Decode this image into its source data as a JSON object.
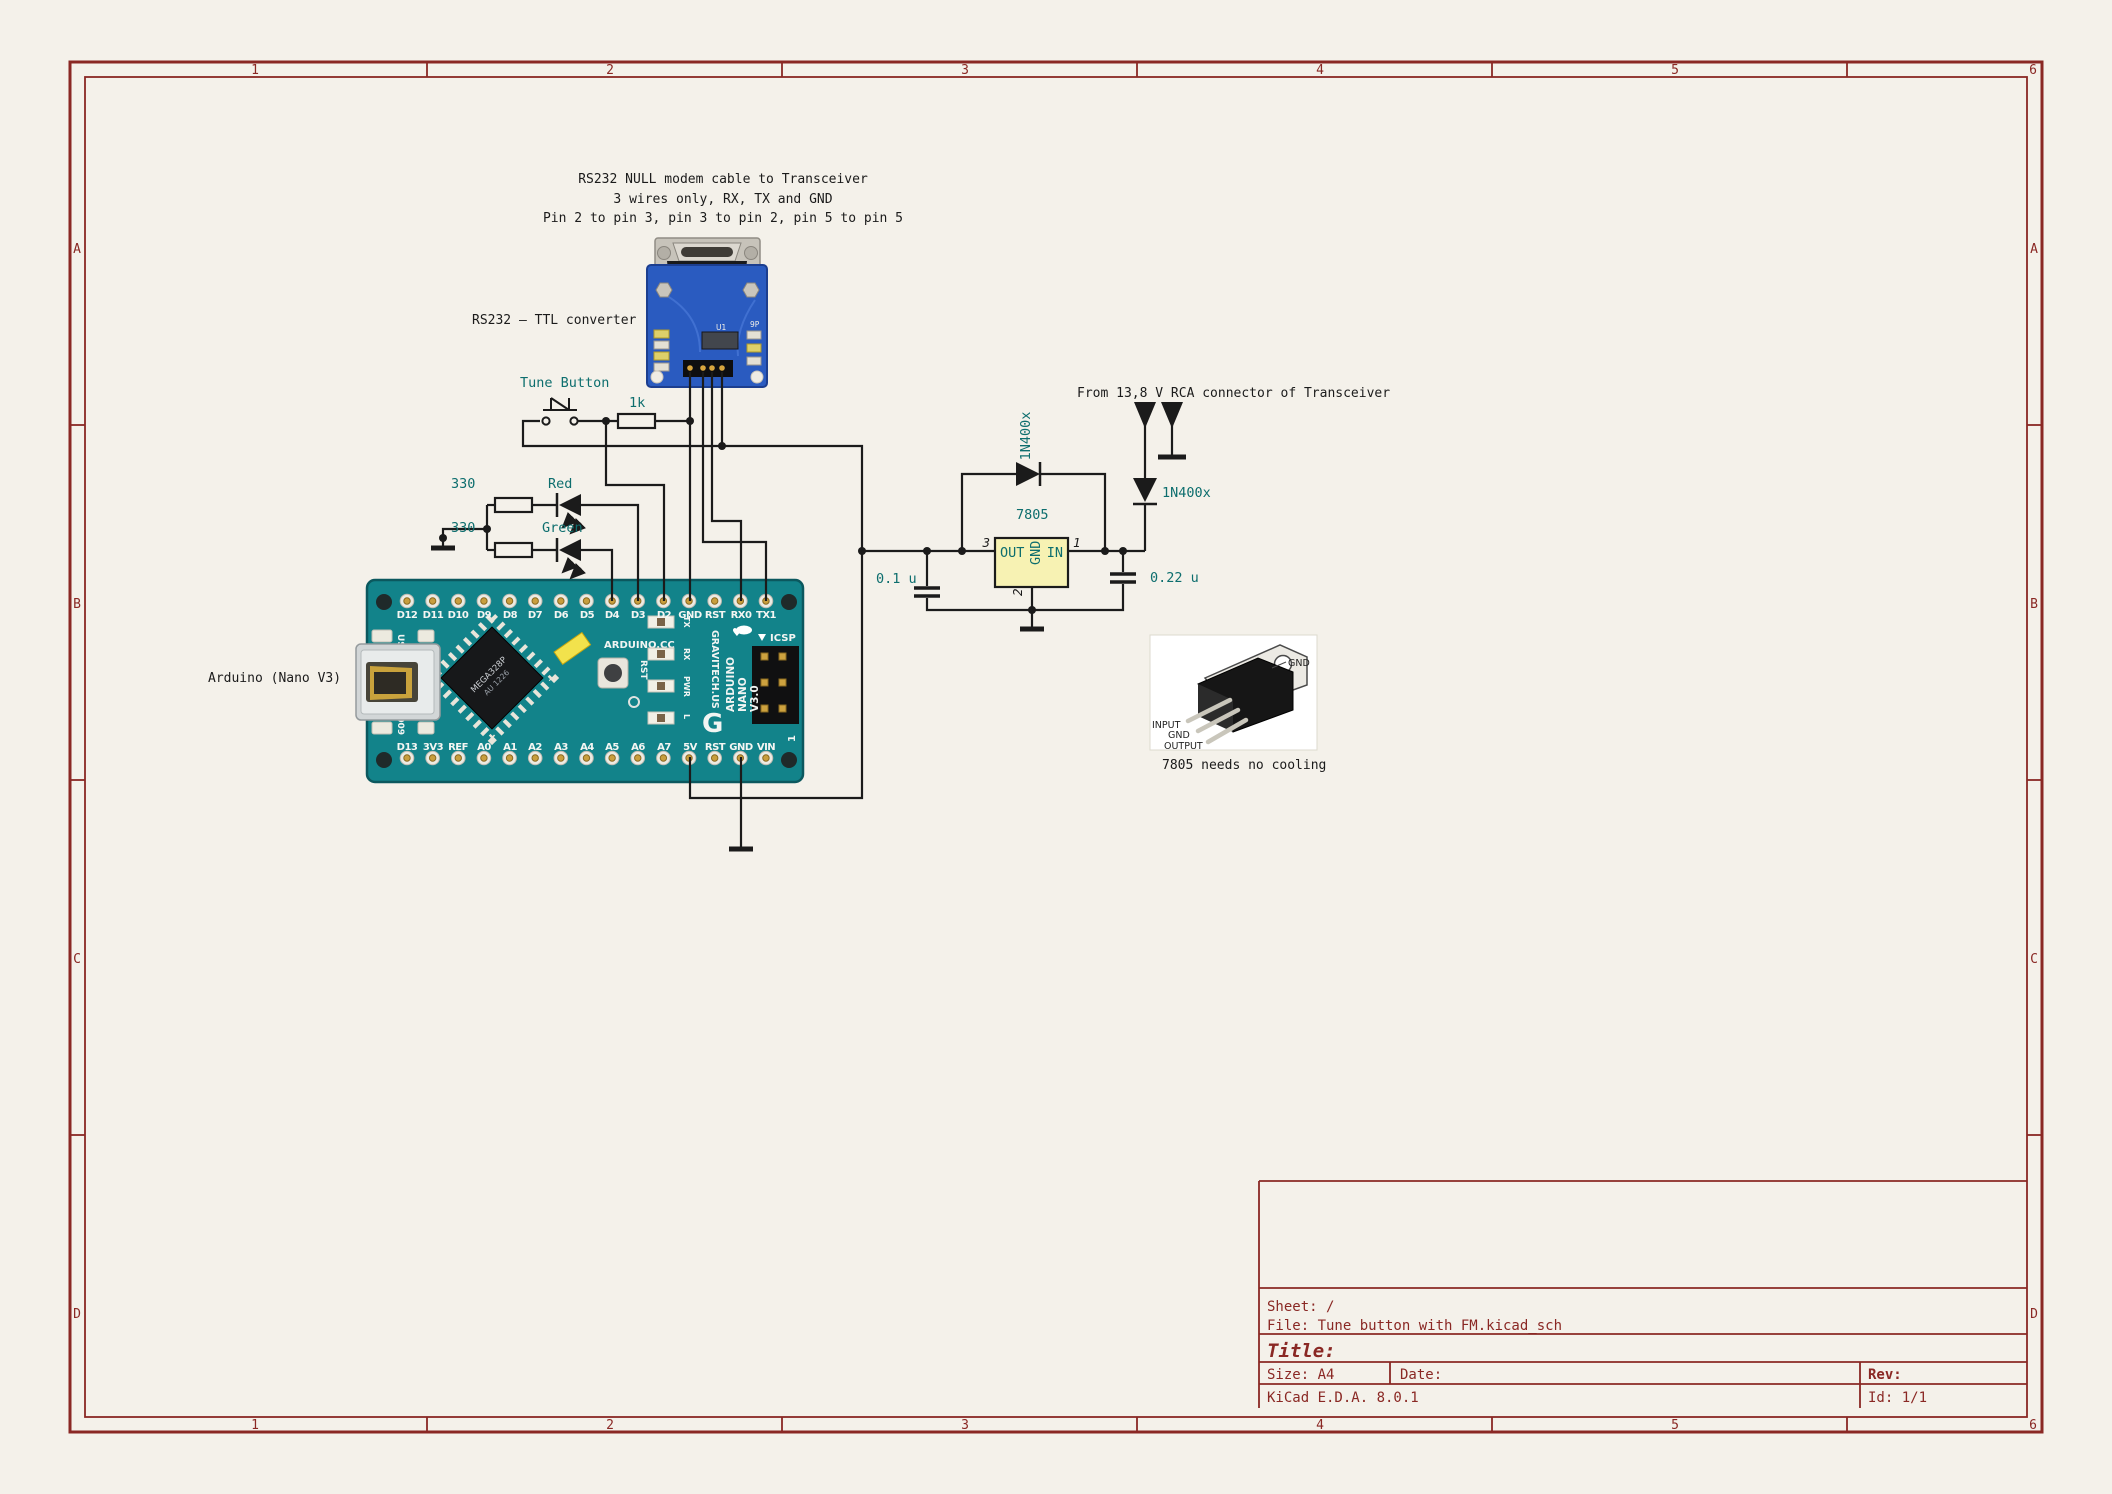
{
  "colors": {
    "paper": "#f4f1ea",
    "frame_maroon": "#8a2824",
    "wire_black": "#1b1b1b",
    "field_teal": "#0d6e6e",
    "symbol_fill": "#f7f2b3",
    "arduino_teal": "#12838a",
    "rs232_blue": "#2a5bc0"
  },
  "frame": {
    "columns": [
      "1",
      "2",
      "3",
      "4",
      "5",
      "6"
    ],
    "rows": [
      "A",
      "B",
      "C",
      "D"
    ]
  },
  "notes": {
    "null_modem_1": "RS232 NULL modem cable to Transceiver",
    "null_modem_2": "3 wires only, RX, TX and GND",
    "null_modem_3": "Pin 2 to pin 3, pin 3 to pin 2, pin 5 to pin 5",
    "converter": "RS232 – TTL converter",
    "arduino": "Arduino (Nano V3)",
    "supply": "From 13,8 V RCA connector of Transceiver",
    "cooling": "7805 needs no cooling"
  },
  "parts": {
    "tune_button": "Tune Button",
    "r_pullup": "1k",
    "r_red": "330",
    "r_green": "330",
    "led_red": "Red",
    "led_green": "Green",
    "d_top": "1N400x",
    "d_in": "1N400x",
    "regulator": "7805",
    "reg_out": "OUT",
    "reg_in": "IN",
    "reg_gnd": "GND",
    "pin3": "3",
    "pin1": "1",
    "pin2": "2",
    "c_out": "0.1 u",
    "c_in": "0.22 u"
  },
  "arduino_board": {
    "top_pins": [
      "D12",
      "D11",
      "D10",
      "D9",
      "D8",
      "D7",
      "D6",
      "D5",
      "D4",
      "D3",
      "D2",
      "GND",
      "RST",
      "RX0",
      "TX1"
    ],
    "bottom_pins": [
      "D13",
      "3V3",
      "REF",
      "A0",
      "A1",
      "A2",
      "A3",
      "A4",
      "A5",
      "A6",
      "A7",
      "5V",
      "RST",
      "GND",
      "VIN"
    ],
    "usa": "USA",
    "year": "2009",
    "chip": "MEGA328P",
    "chip2": "AU 1226",
    "site": "ARDUINO.CC",
    "vendor": "GRAVITECH.US",
    "rst": "RST",
    "led_labels": [
      "TX",
      "RX",
      "PWR",
      "L"
    ],
    "brand": [
      "ARDUINO",
      "NANO",
      "V3.0"
    ],
    "logo": "G",
    "icsp": "ICSP",
    "pin1_mark": "1"
  },
  "rs232_board": {
    "u1": "U1",
    "p9": "9P"
  },
  "to220": {
    "input": "INPUT",
    "gnd": "GND",
    "output": "OUTPUT",
    "tab_gnd": "GND"
  },
  "title_block": {
    "sheet": "Sheet: /",
    "file": "File: Tune button with FM.kicad_sch",
    "title": "Title:",
    "size": "Size: A4",
    "date": "Date:",
    "rev": "Rev:",
    "tool": "KiCad E.D.A. 8.0.1",
    "id": "Id: 1/1"
  }
}
